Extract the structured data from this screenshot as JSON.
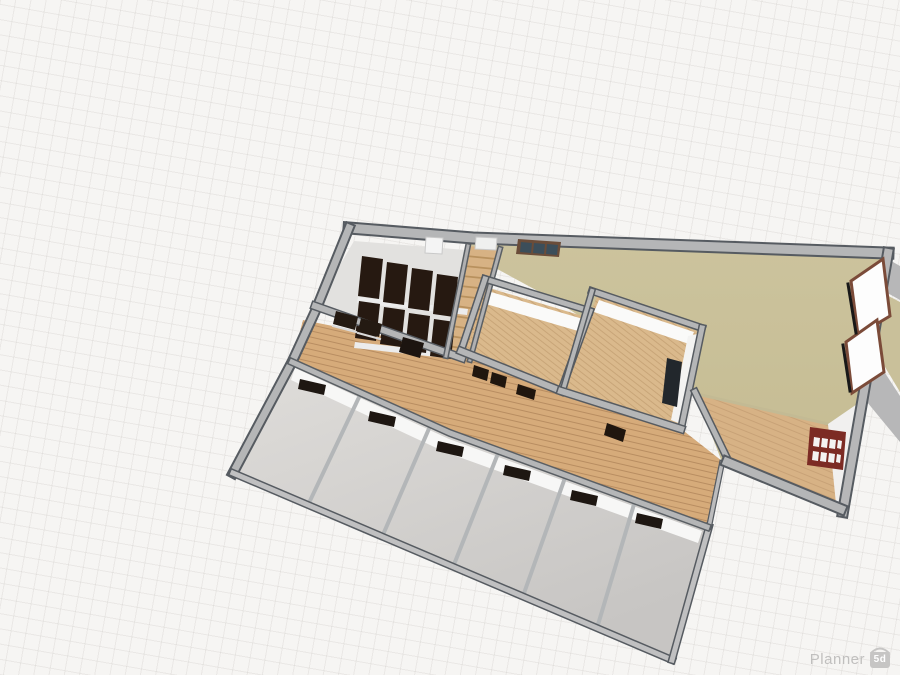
{
  "app": {
    "brand": "Planner",
    "badge": "5d"
  },
  "colors": {
    "background": "#f6f5f3",
    "grid_line": "#cdcac6",
    "wall_top": "#b5b6b7",
    "wall_outline": "#565b61",
    "hall_floor": "#c9c09a",
    "wood_floor": "#dab98c",
    "corridor_floor": "#d6ab7a",
    "small_room_floor": "#d5d3d1",
    "desk": "#261911",
    "red_window_frame": "#7c2b24",
    "brown_window_frame": "#7b4b39",
    "logo_gray": "#c0bfbe"
  },
  "scene": {
    "shapes": [
      {
        "n": "wing-sliver-gray-1",
        "t": "pg",
        "p": "886,258 900,266 900,300 882,290",
        "f": "#b7b7b8",
        "i": "false"
      },
      {
        "n": "wing-sliver-olive",
        "t": "pg",
        "p": "881,292 900,302 900,392 876,352",
        "f": "#c9c09a",
        "i": "false"
      },
      {
        "n": "wing-sliver-gray-2",
        "t": "pg",
        "p": "874,356 900,396 900,442 867,402",
        "f": "#b7b7b8",
        "i": "false"
      },
      {
        "n": "hall-floor",
        "t": "pg",
        "p": "466,242 888,256 843,512 722,462 695,392 558,302 466,252",
        "f": "url(#gOlive)",
        "i": "true"
      },
      {
        "n": "corridor-floor",
        "t": "pg",
        "p": "303,320 462,352 563,393 680,428 722,461 707,527 450,433 292,362",
        "f": "url(#plank)",
        "i": "true"
      },
      {
        "n": "staircase-strip",
        "t": "pg",
        "p": "468,246 500,249 470,360 446,356",
        "f": "#d7b284",
        "i": "true"
      },
      {
        "n": "stair-tread",
        "t": "pl",
        "p": "466,256 497,259",
        "s": "#b8915e",
        "w": 1.8,
        "i": "false"
      },
      {
        "n": "stair-tread",
        "t": "pl",
        "p": "464,266 495,269",
        "s": "#b8915e",
        "w": 1.8,
        "i": "false"
      },
      {
        "n": "stair-tread",
        "t": "pl",
        "p": "462,276 492,279",
        "s": "#b8915e",
        "w": 1.8,
        "i": "false"
      },
      {
        "n": "stair-tread",
        "t": "pl",
        "p": "460,286 489,289",
        "s": "#b8915e",
        "w": 1.8,
        "i": "false"
      },
      {
        "n": "stair-tread",
        "t": "pl",
        "p": "458,296 486,299",
        "s": "#b8915e",
        "w": 1.8,
        "i": "false"
      },
      {
        "n": "stair-tread",
        "t": "pl",
        "p": "456,306 484,310",
        "s": "#b8915e",
        "w": 1.8,
        "i": "false"
      },
      {
        "n": "stair-tread",
        "t": "pl",
        "p": "454,316 481,320",
        "s": "#b8915e",
        "w": 1.8,
        "i": "false"
      },
      {
        "n": "stair-tread",
        "t": "pl",
        "p": "452,326 478,330",
        "s": "#b8915e",
        "w": 1.8,
        "i": "false"
      },
      {
        "n": "stair-tread",
        "t": "pl",
        "p": "450,336 475,340",
        "s": "#b8915e",
        "w": 1.8,
        "i": "false"
      },
      {
        "n": "stair-tread",
        "t": "pl",
        "p": "448,346 473,350",
        "s": "#b8915e",
        "w": 1.8,
        "i": "false"
      },
      {
        "n": "classroom-floor",
        "t": "pg",
        "p": "354,241 466,250 446,356 316,306",
        "f": "#e2e1df",
        "i": "true"
      },
      {
        "n": "chair-row",
        "t": "pg",
        "p": "358,297 468,309 467,315 357,303",
        "f": "#ececec",
        "i": "false"
      },
      {
        "n": "chair-row",
        "t": "pg",
        "p": "355,342 465,354 464,360 354,348",
        "f": "#ececec",
        "i": "false"
      },
      {
        "n": "desk",
        "t": "pg",
        "p": "362,256 383,259 379,299 358,296",
        "f": "#261911",
        "i": "true"
      },
      {
        "n": "desk",
        "t": "pg",
        "p": "387,262 408,265 404,305 383,302",
        "f": "#261911",
        "i": "true"
      },
      {
        "n": "desk",
        "t": "pg",
        "p": "412,268 433,271 429,311 408,308",
        "f": "#261911",
        "i": "true"
      },
      {
        "n": "desk",
        "t": "pg",
        "p": "437,274 458,277 454,317 433,314",
        "f": "#261911",
        "i": "true"
      },
      {
        "n": "desk",
        "t": "pg",
        "p": "359,301 380,304 376,341 355,338",
        "f": "#261911",
        "i": "true"
      },
      {
        "n": "desk",
        "t": "pg",
        "p": "384,307 405,310 401,347 380,344",
        "f": "#261911",
        "i": "true"
      },
      {
        "n": "desk",
        "t": "pg",
        "p": "409,313 430,316 426,353 405,350",
        "f": "#261911",
        "i": "true"
      },
      {
        "n": "desk",
        "t": "pg",
        "p": "434,319 455,322 451,359 430,356",
        "f": "#261911",
        "i": "true"
      },
      {
        "n": "small-rooms-floor",
        "t": "pg",
        "p": "292,362 450,433 707,527 672,660 233,473",
        "f": "url(#gRow)",
        "i": "true"
      },
      {
        "n": "small-rooms-wall-face",
        "t": "pg",
        "p": "295,368 449,439 702,531 698,543 445,452 291,380",
        "f": "#f7f7f6",
        "i": "false"
      },
      {
        "n": "room-divider",
        "t": "pl",
        "p": "361,393 308,505",
        "s": "#b3b6b8",
        "w": 4,
        "i": "false"
      },
      {
        "n": "room-divider",
        "t": "pl",
        "p": "431,424 382,537",
        "s": "#b3b6b8",
        "w": 4,
        "i": "false"
      },
      {
        "n": "room-divider",
        "t": "pl",
        "p": "499,451 453,567",
        "s": "#b3b6b8",
        "w": 4,
        "i": "false"
      },
      {
        "n": "room-divider",
        "t": "pl",
        "p": "566,475 523,596",
        "s": "#b3b6b8",
        "w": 4,
        "i": "false"
      },
      {
        "n": "room-divider",
        "t": "pl",
        "p": "635,501 597,628",
        "s": "#b3b6b8",
        "w": 4,
        "i": "false"
      },
      {
        "n": "center-room-1-floor",
        "t": "pg",
        "p": "489,288 586,317 559,388 465,353",
        "f": "url(#wood)",
        "i": "true"
      },
      {
        "n": "center-room-1-wall-face",
        "t": "pg",
        "p": "491,292 583,319 578,331 486,304",
        "f": "#fafaf9",
        "i": "false"
      },
      {
        "n": "center-room-2-floor",
        "t": "pg",
        "p": "597,296 697,331 678,426 562,391",
        "f": "url(#wood)",
        "i": "true"
      },
      {
        "n": "center-room-2-wall-face-n",
        "t": "pg",
        "p": "599,300 694,332 689,344 594,312",
        "f": "#fafaf9",
        "i": "false"
      },
      {
        "n": "center-room-2-wall-face-e",
        "t": "pg",
        "p": "688,336 697,334 681,424 671,420",
        "f": "#f3f3f2",
        "i": "false"
      },
      {
        "n": "se-room-floor",
        "t": "pg",
        "p": "697,394 828,424 838,506 729,462",
        "f": "url(#plank2)",
        "i": "true"
      },
      {
        "n": "floor-boundary",
        "t": "pl",
        "p": "697,394 828,424",
        "s": "#c3ba94",
        "w": 3,
        "i": "false"
      },
      {
        "n": "se-room-east-wall-face",
        "t": "pg",
        "p": "828,424 860,402 846,510 836,504",
        "f": "#f1f0ef",
        "i": "false"
      },
      {
        "n": "north-wall-outline",
        "t": "pl",
        "p": "349,228 473,238 888,253",
        "s": "#565b61",
        "w": 13,
        "i": "false"
      },
      {
        "n": "north-wall",
        "t": "pl",
        "p": "349,228 473,238 888,253",
        "s": "#b5b6b7",
        "w": 9,
        "i": "false"
      },
      {
        "n": "west-wall-outline",
        "t": "pl",
        "p": "349,228 315,312 292,362 233,473",
        "s": "#565b61",
        "w": 11,
        "i": "false"
      },
      {
        "n": "west-wall",
        "t": "pl",
        "p": "349,228 315,312 292,362 233,473",
        "s": "#b5b6b7",
        "w": 7,
        "i": "false"
      },
      {
        "n": "east-wall-outline",
        "t": "pl",
        "p": "888,253 843,512",
        "s": "#565b61",
        "w": 12,
        "i": "false"
      },
      {
        "n": "east-wall",
        "t": "pl",
        "p": "888,253 843,512",
        "s": "#b7b7b8",
        "w": 8,
        "i": "false"
      },
      {
        "n": "south-wall-outline",
        "t": "pl",
        "p": "233,473 672,660",
        "s": "#565b61",
        "w": 8,
        "i": "false"
      },
      {
        "n": "south-wall",
        "t": "pl",
        "p": "233,473 672,660",
        "s": "#c0c0c1",
        "w": 5,
        "i": "false"
      },
      {
        "n": "rooms-east-wall-outline",
        "t": "pl",
        "p": "672,660 709,527",
        "s": "#565b61",
        "w": 8,
        "i": "false"
      },
      {
        "n": "rooms-east-wall",
        "t": "pl",
        "p": "672,660 709,527",
        "s": "#c0c0c1",
        "w": 5,
        "i": "false"
      },
      {
        "n": "notch-wall-outline",
        "t": "pl",
        "p": "709,527 722,463",
        "s": "#565b61",
        "w": 6,
        "i": "false"
      },
      {
        "n": "notch-wall",
        "t": "pl",
        "p": "709,527 722,463",
        "s": "#bcbcbd",
        "w": 3.5,
        "i": "false"
      },
      {
        "n": "rooms-north-wall-outline",
        "t": "pl",
        "p": "292,362 450,433 707,527",
        "s": "#5a5f64",
        "w": 8,
        "i": "false"
      },
      {
        "n": "rooms-north-wall",
        "t": "pl",
        "p": "292,362 450,433 707,527",
        "s": "#b5b6b7",
        "w": 5,
        "i": "false"
      },
      {
        "n": "classroom-south-wall-outline",
        "t": "pl",
        "p": "315,306 462,358",
        "s": "#565b61",
        "w": 9,
        "i": "false"
      },
      {
        "n": "classroom-south-wall",
        "t": "pl",
        "p": "315,306 462,358",
        "s": "#b5b6b7",
        "w": 6,
        "i": "false"
      },
      {
        "n": "stair-west-wall-outline",
        "t": "pl",
        "p": "468,246 446,356",
        "s": "#5a5f64",
        "w": 6,
        "i": "false"
      },
      {
        "n": "stair-west-wall",
        "t": "pl",
        "p": "468,246 446,356",
        "s": "#b0b0b1",
        "w": 3,
        "i": "false"
      },
      {
        "n": "stair-east-wall-outline",
        "t": "pl",
        "p": "500,249 470,360",
        "s": "#5a5f64",
        "w": 6,
        "i": "false"
      },
      {
        "n": "stair-east-wall",
        "t": "pl",
        "p": "500,249 470,360",
        "s": "#b0b0b1",
        "w": 3,
        "i": "false"
      },
      {
        "n": "room1-north-wall-outline",
        "t": "pl",
        "p": "485,279 590,311",
        "s": "#565b61",
        "w": 8,
        "i": "false"
      },
      {
        "n": "room1-north-wall",
        "t": "pl",
        "p": "485,279 590,311",
        "s": "#b5b6b7",
        "w": 5,
        "i": "false"
      },
      {
        "n": "room1-west-wall-outline",
        "t": "pl",
        "p": "485,279 461,351",
        "s": "#565b61",
        "w": 8,
        "i": "false"
      },
      {
        "n": "room1-west-wall",
        "t": "pl",
        "p": "485,279 461,351",
        "s": "#b5b6b7",
        "w": 5,
        "i": "false"
      },
      {
        "n": "room1-east-wall-outline",
        "t": "pl",
        "p": "590,311 561,391",
        "s": "#565b61",
        "w": 8,
        "i": "false"
      },
      {
        "n": "room1-east-wall",
        "t": "pl",
        "p": "590,311 561,391",
        "s": "#b5b6b7",
        "w": 5,
        "i": "false"
      },
      {
        "n": "room1-south-wall-outline",
        "t": "pl",
        "p": "461,351 561,391",
        "s": "#565b61",
        "w": 9,
        "i": "false"
      },
      {
        "n": "room1-south-wall",
        "t": "pl",
        "p": "461,351 561,391",
        "s": "#b5b6b7",
        "w": 6,
        "i": "false"
      },
      {
        "n": "room2-north-wall-outline",
        "t": "pl",
        "p": "592,291 702,328",
        "s": "#565b61",
        "w": 8,
        "i": "false"
      },
      {
        "n": "room2-north-wall",
        "t": "pl",
        "p": "592,291 702,328",
        "s": "#b5b6b7",
        "w": 5,
        "i": "false"
      },
      {
        "n": "room2-west-wall-outline",
        "t": "pl",
        "p": "592,291 563,390",
        "s": "#565b61",
        "w": 7,
        "i": "false"
      },
      {
        "n": "room2-west-wall",
        "t": "pl",
        "p": "592,291 563,390",
        "s": "#b5b6b7",
        "w": 4,
        "i": "false"
      },
      {
        "n": "room2-east-wall-outline",
        "t": "pl",
        "p": "702,328 681,429",
        "s": "#565b61",
        "w": 8,
        "i": "false"
      },
      {
        "n": "room2-east-wall",
        "t": "pl",
        "p": "702,328 681,429",
        "s": "#b5b6b7",
        "w": 5,
        "i": "false"
      },
      {
        "n": "room2-south-wall-outline",
        "t": "pl",
        "p": "561,391 681,429",
        "s": "#565b61",
        "w": 9,
        "i": "false"
      },
      {
        "n": "room2-south-wall",
        "t": "pl",
        "p": "561,391 681,429",
        "s": "#b5b6b7",
        "w": 6,
        "i": "false"
      },
      {
        "n": "se-room-west-wall-outline",
        "t": "pl",
        "p": "695,392 729,462",
        "s": "#565b61",
        "w": 8,
        "i": "false"
      },
      {
        "n": "se-room-west-wall",
        "t": "pl",
        "p": "695,392 729,462",
        "s": "#b5b6b7",
        "w": 5,
        "i": "false"
      },
      {
        "n": "se-room-south-wall-outline",
        "t": "pl",
        "p": "727,462 841,509",
        "s": "#565b61",
        "w": 12,
        "i": "false"
      },
      {
        "n": "se-room-south-wall",
        "t": "pl",
        "p": "727,462 841,509",
        "s": "#b5b6b7",
        "w": 8,
        "i": "false"
      },
      {
        "n": "classroom-window",
        "t": "pg",
        "p": "336,311 358,317 355,330 333,324",
        "f": "#241a12",
        "i": "true"
      },
      {
        "n": "classroom-window",
        "t": "pg",
        "p": "361,318 382,324 379,337 358,331",
        "f": "#241a12",
        "i": "true"
      },
      {
        "n": "window-sill",
        "t": "pl",
        "p": "333,326 356,332",
        "s": "#d9d9d9",
        "w": 2,
        "i": "false"
      },
      {
        "n": "window-sill",
        "t": "pl",
        "p": "358,333 380,339",
        "s": "#d9d9d9",
        "w": 2,
        "i": "false"
      },
      {
        "n": "classroom-door",
        "t": "pg",
        "p": "403,337 424,343 420,358 399,352",
        "f": "#1c1410",
        "i": "true"
      },
      {
        "n": "room-door",
        "t": "pg",
        "p": "300,379 326,385 324,395 298,389",
        "f": "#1e1712",
        "i": "true"
      },
      {
        "n": "room-door",
        "t": "pg",
        "p": "370,411 396,417 394,427 368,421",
        "f": "#1e1712",
        "i": "true"
      },
      {
        "n": "room-door",
        "t": "pg",
        "p": "438,441 464,447 462,457 436,451",
        "f": "#1e1712",
        "i": "true"
      },
      {
        "n": "room-door",
        "t": "pg",
        "p": "505,465 531,471 529,481 503,475",
        "f": "#1e1712",
        "i": "true"
      },
      {
        "n": "room-door",
        "t": "pg",
        "p": "572,490 598,496 596,506 570,500",
        "f": "#1e1712",
        "i": "true"
      },
      {
        "n": "room-door",
        "t": "pg",
        "p": "637,513 663,519 661,529 635,523",
        "f": "#1e1712",
        "i": "true"
      },
      {
        "n": "room1-window",
        "t": "pg",
        "p": "474,365 489,370 487,381 472,376",
        "f": "#20160e",
        "i": "true"
      },
      {
        "n": "room1-window",
        "t": "pg",
        "p": "492,372 507,377 505,388 490,383",
        "f": "#20160e",
        "i": "true"
      },
      {
        "n": "room1-window",
        "t": "pg",
        "p": "518,384 536,390 534,400 516,394",
        "f": "#20160e",
        "i": "true"
      },
      {
        "n": "room2-door",
        "t": "pg",
        "p": "607,423 626,430 623,442 604,435",
        "f": "#20160e",
        "i": "true"
      },
      {
        "n": "room2-east-window",
        "t": "pg",
        "p": "667,358 682,362 677,407 662,403",
        "f": "#22272c",
        "i": "true"
      },
      {
        "n": "east-window",
        "t": "pg",
        "p": "851,281 883,259 890,316 858,335",
        "f": "#fdfdfd",
        "s": "#7b4b39",
        "w": 3,
        "i": "true"
      },
      {
        "n": "east-window",
        "t": "pg",
        "p": "846,342 877,320 884,372 852,393",
        "f": "#fdfdfd",
        "s": "#7b4b39",
        "w": 3,
        "i": "true"
      },
      {
        "n": "window-shadow",
        "t": "pl",
        "p": "848,284 856,333",
        "s": "#181818",
        "w": 3,
        "i": "false"
      },
      {
        "n": "window-shadow",
        "t": "pl",
        "p": "843,345 850,391",
        "s": "#181818",
        "w": 3,
        "i": "false"
      },
      {
        "n": "north-skylight",
        "t": "pg",
        "p": "426,237 443,238 442,254 425,253",
        "f": "#f4f4f4",
        "s": "#c9c9c9",
        "w": 1,
        "i": "true"
      },
      {
        "n": "north-skylight",
        "t": "pg",
        "p": "476,237 497,238 496,250 475,249",
        "f": "#eff0ef",
        "s": "#c9c9c9",
        "w": 1,
        "i": "true"
      },
      {
        "n": "north-window-frame",
        "t": "pg",
        "p": "518,239 561,242 559,257 516,254",
        "f": "#6a4c39",
        "i": "true"
      },
      {
        "n": "north-window-pane",
        "t": "pg",
        "p": "521,242 532,243 531,253 520,252",
        "f": "#3c4e5a",
        "i": "false"
      },
      {
        "n": "north-window-pane",
        "t": "pg",
        "p": "534,243 545,244 544,254 533,253",
        "f": "#3c4e5a",
        "i": "false"
      },
      {
        "n": "north-window-pane",
        "t": "pg",
        "p": "547,244 558,245 557,255 546,254",
        "f": "#3c4e5a",
        "i": "false"
      },
      {
        "n": "red-window-frame",
        "t": "pg",
        "p": "810,427 846,432 843,470 807,465",
        "f": "#7c2b24",
        "i": "true"
      },
      {
        "n": "red-window-pane",
        "t": "pg",
        "p": "814,437 820,438 819,447 813,446",
        "f": "#f4f3f2",
        "i": "false"
      },
      {
        "n": "red-window-pane",
        "t": "pg",
        "p": "822,438 828,439 827,448 821,447",
        "f": "#f4f3f2",
        "i": "false"
      },
      {
        "n": "red-window-pane",
        "t": "pg",
        "p": "830,439 836,440 835,449 829,448",
        "f": "#f4f3f2",
        "i": "false"
      },
      {
        "n": "red-window-pane",
        "t": "pg",
        "p": "838,440 842,441 841,449 837,448",
        "f": "#f4f3f2",
        "i": "false"
      },
      {
        "n": "red-window-pane",
        "t": "pg",
        "p": "813,451 819,452 818,461 812,460",
        "f": "#f4f3f2",
        "i": "false"
      },
      {
        "n": "red-window-pane",
        "t": "pg",
        "p": "821,452 827,453 826,462 820,461",
        "f": "#f4f3f2",
        "i": "false"
      },
      {
        "n": "red-window-pane",
        "t": "pg",
        "p": "829,453 835,454 834,463 828,462",
        "f": "#f4f3f2",
        "i": "false"
      },
      {
        "n": "red-window-pane",
        "t": "pg",
        "p": "837,454 841,455 840,463 836,462",
        "f": "#f4f3f2",
        "i": "false"
      }
    ]
  }
}
